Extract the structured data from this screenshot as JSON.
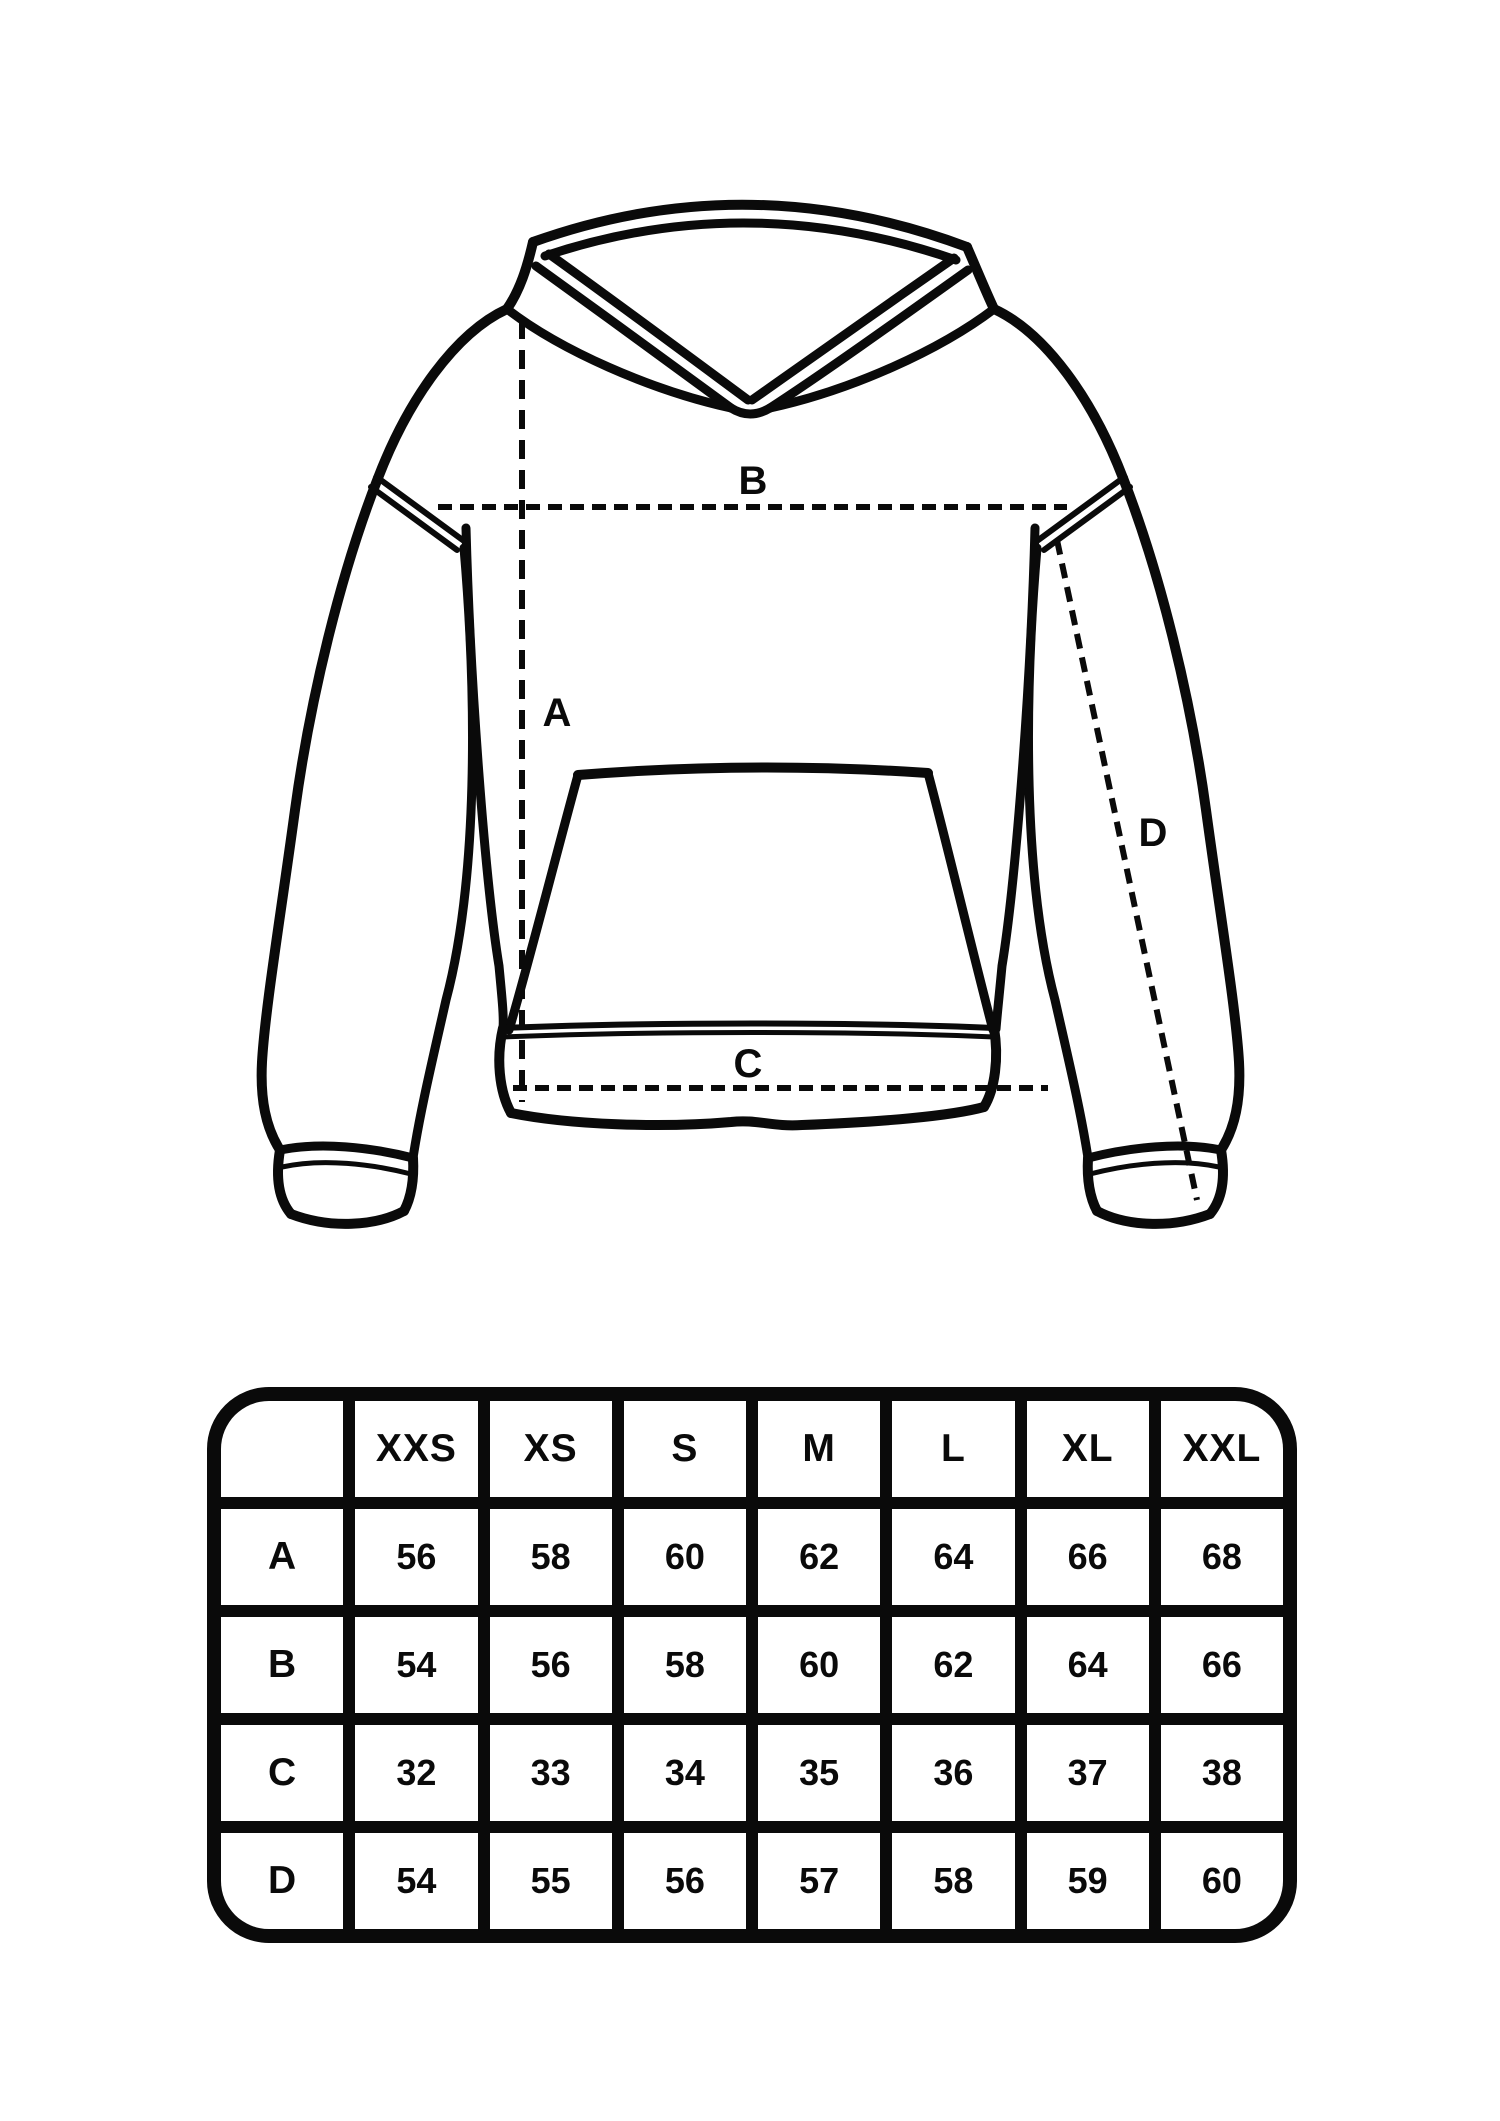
{
  "page": {
    "background_color": "#ffffff",
    "ink_color": "#0a0a0a",
    "description": "Hoodie flat technical sketch with measurement guide lines and size table"
  },
  "diagram": {
    "garment": "hooded-sweatshirt-front-view",
    "measure_labels": {
      "A": "A",
      "B": "B",
      "C": "C",
      "D": "D"
    }
  },
  "size_table": {
    "columns": [
      "",
      "XXS",
      "XS",
      "S",
      "M",
      "L",
      "XL",
      "XXL"
    ],
    "rows": [
      {
        "label": "A",
        "values": [
          "56",
          "58",
          "60",
          "62",
          "64",
          "66",
          "68"
        ]
      },
      {
        "label": "B",
        "values": [
          "54",
          "56",
          "58",
          "60",
          "62",
          "64",
          "66"
        ]
      },
      {
        "label": "C",
        "values": [
          "32",
          "33",
          "34",
          "35",
          "36",
          "37",
          "38"
        ]
      },
      {
        "label": "D",
        "values": [
          "54",
          "55",
          "56",
          "57",
          "58",
          "59",
          "60"
        ]
      }
    ]
  }
}
